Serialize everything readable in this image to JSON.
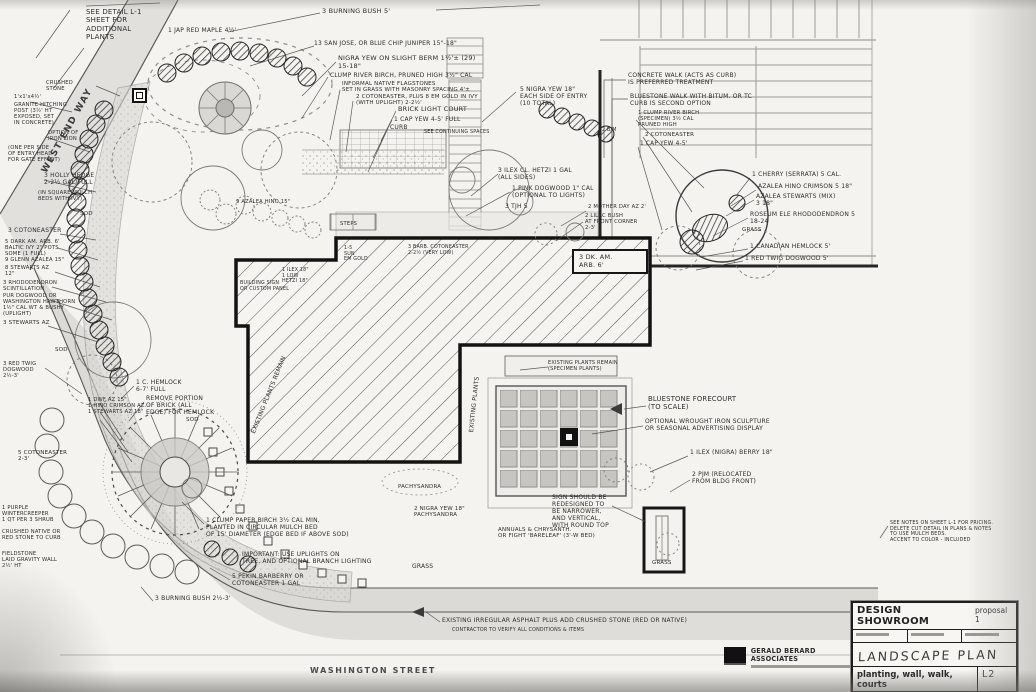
{
  "drawing": {
    "streets": {
      "bottom": "WASHINGTON STREET",
      "side": "WEST END WAY"
    },
    "title_block": {
      "project": "DESIGN SHOWROOM",
      "proposal": "proposal 1",
      "sheet_title": "LANDSCAPE PLAN",
      "sheet_subtitle": "planting, wall, walk, courts",
      "sheet_number": "L2"
    },
    "stamp": {
      "firm": "GERALD BERARD ASSOCIATES"
    },
    "colors": {
      "ink": "#1a1a1a",
      "paper": "#f2f1ed"
    },
    "annotations": [
      {
        "x": 86,
        "y": 8,
        "fs": 7,
        "w": 72,
        "t": "SEE DETAIL L-1\nSHEET FOR\nADDITIONAL\nPLANTS"
      },
      {
        "x": 168,
        "y": 27,
        "fs": 6,
        "w": 140,
        "t": "1 JAP RED MAPLE 4½'"
      },
      {
        "x": 322,
        "y": 8,
        "fs": 6.5,
        "w": 130,
        "t": "3 BURNING BUSH   5'"
      },
      {
        "x": 314,
        "y": 40,
        "fs": 6,
        "w": 210,
        "t": "13  SAN JOSE, OR BLUE CHIP JUNIPER 15\"-18\""
      },
      {
        "x": 338,
        "y": 55,
        "fs": 6.5,
        "w": 190,
        "t": "NIGRA YEW ON SLIGHT BERM 1½'±  (29)\n15-18\""
      },
      {
        "x": 330,
        "y": 72,
        "fs": 6,
        "w": 200,
        "t": "CLUMP RIVER BIRCH, PRUNED HIGH  3½\" CAL"
      },
      {
        "x": 342,
        "y": 81,
        "fs": 5.5,
        "w": 175,
        "t": "INFORMAL NATIVE FLAGSTONES\nSET IN GRASS WITH MASONRY SPACING 4'±"
      },
      {
        "x": 356,
        "y": 94,
        "fs": 5.5,
        "w": 185,
        "t": "2 COTONEASTER, PLUS 8 EM GOLD IN IVY\n(WITH UPLIGHT) 2-2½'"
      },
      {
        "x": 398,
        "y": 106,
        "fs": 6.5,
        "w": 120,
        "t": "BRICK LIGHT COURT"
      },
      {
        "x": 394,
        "y": 116,
        "fs": 6,
        "w": 120,
        "t": "1 CAP YEW 4-5' FULL"
      },
      {
        "x": 390,
        "y": 124,
        "fs": 6,
        "w": 60,
        "t": "CURB"
      },
      {
        "x": 424,
        "y": 130,
        "fs": 4.8,
        "w": 90,
        "t": "SEE CONTINUING SPACES"
      },
      {
        "x": 520,
        "y": 86,
        "fs": 6,
        "w": 110,
        "t": "5 NIGRA YEW 18\"\nEACH SIDE OF ENTRY\n(10 TOTAL)"
      },
      {
        "x": 628,
        "y": 72,
        "fs": 6,
        "w": 175,
        "t": "CONCRETE WALK (ACTS AS CURB)\nIS PREFERRED TREATMENT"
      },
      {
        "x": 630,
        "y": 93,
        "fs": 6,
        "w": 185,
        "t": "BLUESTONE WALK WITH BITUM. OR TC\nCURB IS SECOND OPTION"
      },
      {
        "x": 602,
        "y": 128,
        "fs": 4.8,
        "w": 30,
        "t": "2 B/M"
      },
      {
        "x": 638,
        "y": 110,
        "fs": 5.2,
        "w": 110,
        "t": "1 CLUMP RIVER BIRCH\n(SPECIMEN) 3½ CAL\nPRUNED HIGH"
      },
      {
        "x": 645,
        "y": 132,
        "fs": 5.5,
        "w": 100,
        "t": "2 COTONEASTER"
      },
      {
        "x": 640,
        "y": 141,
        "fs": 5.8,
        "w": 110,
        "t": "1 CAP YEW 4-5'"
      },
      {
        "x": 498,
        "y": 167,
        "fs": 6,
        "w": 170,
        "t": "3 ILEX CL. HETZI  1 GAL\n(ALL SIDES)"
      },
      {
        "x": 512,
        "y": 185,
        "fs": 6,
        "w": 160,
        "t": "1 PINK DOGWOOD 1\" CAL\n(OPTIONAL TO LIGHTS)"
      },
      {
        "x": 505,
        "y": 203,
        "fs": 6,
        "w": 70,
        "t": "3 TJH 5"
      },
      {
        "x": 588,
        "y": 204,
        "fs": 5.2,
        "w": 110,
        "t": "2 MOTHER DAY AZ 2'"
      },
      {
        "x": 585,
        "y": 213,
        "fs": 5.2,
        "w": 100,
        "t": "2 LILAC BUSH\nAT FRONT CORNER\n2-3'"
      },
      {
        "x": 572,
        "y": 249,
        "fs": 6.5,
        "w": 62,
        "b": true,
        "t": "3 DK. AM.\nARB.  6'"
      },
      {
        "x": 752,
        "y": 171,
        "fs": 6,
        "w": 150,
        "t": "1 CHERRY (SERRATA) 5 CAL."
      },
      {
        "x": 758,
        "y": 183,
        "fs": 6,
        "w": 150,
        "t": "AZALEA HINO CRIMSON 5  18\""
      },
      {
        "x": 756,
        "y": 193,
        "fs": 6,
        "w": 150,
        "t": "AZALEA STEWARTS (MIX)\n3    18\""
      },
      {
        "x": 750,
        "y": 211,
        "fs": 6,
        "w": 160,
        "t": "ROSEUM ELE RHODODENDRON 5\n18-24"
      },
      {
        "x": 742,
        "y": 227,
        "fs": 5.5,
        "w": 60,
        "t": "GRASS"
      },
      {
        "x": 750,
        "y": 243,
        "fs": 6,
        "w": 150,
        "t": "1 CANADIAN HEMLOCK  5'"
      },
      {
        "x": 745,
        "y": 255,
        "fs": 6,
        "w": 150,
        "t": "1 RED TWIG DOGWOOD    5'"
      },
      {
        "x": 46,
        "y": 80,
        "fs": 5.2,
        "w": 55,
        "t": "CRUSHED\nSTONE"
      },
      {
        "x": 14,
        "y": 94,
        "fs": 5.2,
        "w": 70,
        "t": "1'x1'x4½'"
      },
      {
        "x": 14,
        "y": 102,
        "fs": 5.2,
        "w": 78,
        "t": "GRANITE HITCHING\nPOST (3½' HT\nEXPOSED, SET\nIN CONCRETE)"
      },
      {
        "x": 48,
        "y": 130,
        "fs": 5.2,
        "w": 64,
        "t": "OPTION OF\nIRON LION"
      },
      {
        "x": 8,
        "y": 145,
        "fs": 5.2,
        "w": 92,
        "t": "(ONE PER SIDE\nOF ENTRY HEAD\nFOR GATE EFFECT)"
      },
      {
        "x": 44,
        "y": 172,
        "fs": 6,
        "w": 92,
        "t": "3 HOLLY HEDGE\n2-2½ GAL/FULL"
      },
      {
        "x": 38,
        "y": 190,
        "fs": 5.2,
        "w": 96,
        "t": "(IN SQUARE MULCH\nBEDS WITH IVY)"
      },
      {
        "x": 80,
        "y": 211,
        "fs": 5.5,
        "w": 40,
        "t": "SOD"
      },
      {
        "x": 8,
        "y": 227,
        "fs": 6,
        "w": 92,
        "t": "3 COTONEASTER"
      },
      {
        "x": 5,
        "y": 239,
        "fs": 5.2,
        "w": 96,
        "t": "5 DARK AM. ARB. 6'\nBALTIC IVY 2\" POTS\nSOME (1 FULL)\n9 GLENN AZALEA 15\""
      },
      {
        "x": 5,
        "y": 265,
        "fs": 5.2,
        "w": 92,
        "t": "8 STEWARTS AZ\n12\""
      },
      {
        "x": 3,
        "y": 280,
        "fs": 5.2,
        "w": 96,
        "t": "3 RHODODENDRON\nSCINTILLATION"
      },
      {
        "x": 3,
        "y": 293,
        "fs": 5.2,
        "w": 102,
        "t": "PUR DOGWOOD OR\nWASHINGTON HAWTHORN\n1½\" CAL  WT & BUSHY\n(UPLIGHT)"
      },
      {
        "x": 3,
        "y": 320,
        "fs": 5.5,
        "w": 92,
        "t": "3 STEWARTS AZ"
      },
      {
        "x": 55,
        "y": 347,
        "fs": 5.5,
        "w": 40,
        "t": "SOD"
      },
      {
        "x": 3,
        "y": 361,
        "fs": 5.2,
        "w": 70,
        "t": "3 RED TWIG\nDOGWOOD\n2½-3'"
      },
      {
        "x": 136,
        "y": 379,
        "fs": 6,
        "w": 100,
        "t": "1 C. HEMLOCK\n6-7' FULL"
      },
      {
        "x": 146,
        "y": 395,
        "fs": 6,
        "w": 120,
        "t": "REMOVE PORTION\nOF BRICK (ALL\nEDGE) FOR HEMLOCK"
      },
      {
        "x": 88,
        "y": 397,
        "fs": 5.2,
        "w": 100,
        "t": "1 DWF AZ 15\"\n1 HINO CRIMSON AZ\n1 STEWARTS AZ 18\""
      },
      {
        "x": 18,
        "y": 450,
        "fs": 5.5,
        "w": 86,
        "t": "5 COTONEASTER\n2-3'"
      },
      {
        "x": 186,
        "y": 417,
        "fs": 5.5,
        "w": 40,
        "t": "SOD"
      },
      {
        "x": 2,
        "y": 505,
        "fs": 5.2,
        "w": 88,
        "t": "1 PURPLE\nWINTERCREEPER\n1 QT PER 3 SHRUB"
      },
      {
        "x": 2,
        "y": 529,
        "fs": 5.2,
        "w": 96,
        "t": "CRUSHED NATIVE OR\nRED STONE TO CURB"
      },
      {
        "x": 2,
        "y": 551,
        "fs": 5.2,
        "w": 92,
        "t": "FIELDSTONE\nLAID GRAVITY WALL\n2½' HT"
      },
      {
        "x": 155,
        "y": 595,
        "fs": 6,
        "w": 140,
        "t": "3 BURNING BUSH 2½-3'"
      },
      {
        "x": 206,
        "y": 517,
        "fs": 6,
        "w": 195,
        "t": "1 CLUMP PAPER BIRCH 3½ CAL MIN,\nPLANTED IN CIRCULAR MULCH BED\nOF 15' DIAMETER (EDGE BED IF ABOVE SOD)"
      },
      {
        "x": 242,
        "y": 551,
        "fs": 6,
        "w": 195,
        "t": "IMPORTANT: USE UPLIGHTS ON\nTREE, AND OPTIONAL BRANCH LIGHTING"
      },
      {
        "x": 232,
        "y": 573,
        "fs": 6,
        "w": 150,
        "t": "5 PEKIN BARBERRY OR\nCOTONEASTER 1 GAL"
      },
      {
        "x": 414,
        "y": 506,
        "fs": 5.5,
        "w": 110,
        "t": "2 NIGRA YEW 18\"\nPACHYSANDRA"
      },
      {
        "x": 498,
        "y": 527,
        "fs": 5.5,
        "w": 175,
        "t": "ANNUALS & CHRYSANTH.\nOR FIGHT 'BARELEAF' (3'-W BED)"
      },
      {
        "x": 398,
        "y": 484,
        "fs": 5.5,
        "w": 90,
        "t": "PACHYSANDRA"
      },
      {
        "x": 648,
        "y": 395,
        "fs": 6.8,
        "w": 155,
        "t": "BLUESTONE FORECOURT\n(TO SCALE)"
      },
      {
        "x": 645,
        "y": 418,
        "fs": 6,
        "w": 190,
        "t": "OPTIONAL WROUGHT IRON SCULPTURE\nOR SEASONAL ADVERTISING DISPLAY"
      },
      {
        "x": 690,
        "y": 449,
        "fs": 6,
        "w": 145,
        "t": "1 ILEX (NIGRA) BERRY 18\""
      },
      {
        "x": 692,
        "y": 471,
        "fs": 6,
        "w": 120,
        "t": "2 PJM (RELOCATED\nFROM BLDG FRONT)"
      },
      {
        "x": 552,
        "y": 494,
        "fs": 6,
        "w": 95,
        "t": "SIGN SHOULD BE\nREDESIGNED TO\nBE NARROWER,\nAND VERTICAL,\nWITH ROUND TOP"
      },
      {
        "x": 890,
        "y": 521,
        "fs": 4.8,
        "w": 128,
        "t": "SEE NOTES ON SHEET L-1 FOR PRICING.\nDELETE CUT DETAIL IN PLANS & NOTES\nTO USE MULCH BEDS.\nACCENT TO COLOR - INCLUDED"
      },
      {
        "x": 442,
        "y": 617,
        "fs": 6,
        "w": 480,
        "t": "EXISTING IRREGULAR ASPHALT PLUS ADD CRUSHED STONE (RED OR NATIVE)"
      },
      {
        "x": 452,
        "y": 628,
        "fs": 4.8,
        "w": 260,
        "t": "CONTRACTOR TO VERIFY ALL CONDITIONS & ITEMS"
      },
      {
        "x": 412,
        "y": 563,
        "fs": 6,
        "w": 60,
        "t": "GRASS"
      },
      {
        "x": 652,
        "y": 560,
        "fs": 5.5,
        "w": 60,
        "t": "GRASS"
      },
      {
        "x": 548,
        "y": 361,
        "fs": 5,
        "w": 145,
        "t": "EXISTING PLANTS REMAIN\n(SPECIMEN PLANTS)"
      },
      {
        "x": 250,
        "y": 432,
        "fs": 6,
        "r": -68,
        "w": 130,
        "t": "EXISTING PLANTS REMAIN"
      },
      {
        "x": 468,
        "y": 432,
        "fs": 6,
        "r": -84,
        "w": 100,
        "t": "EXISTING PLANTS"
      },
      {
        "x": 340,
        "y": 221,
        "fs": 5.2,
        "w": 50,
        "t": "STEPS"
      },
      {
        "x": 344,
        "y": 246,
        "fs": 4.8,
        "w": 50,
        "t": "1-5\nSUN\nEM GOLD"
      },
      {
        "x": 408,
        "y": 245,
        "fs": 4.8,
        "w": 95,
        "t": "3 BARB. COTONEASTER\n2-2½ (VERY LOW)"
      },
      {
        "x": 240,
        "y": 281,
        "fs": 4.8,
        "w": 78,
        "t": "BUILDING SIGN\nOR CUSTOM PANEL"
      },
      {
        "x": 282,
        "y": 268,
        "fs": 4.8,
        "w": 60,
        "t": "1 ILEX 18\"\n1 LOW\nHETZI 18\""
      },
      {
        "x": 236,
        "y": 199,
        "fs": 5.2,
        "w": 95,
        "t": "9 AZALEA HINO 15\""
      }
    ]
  }
}
